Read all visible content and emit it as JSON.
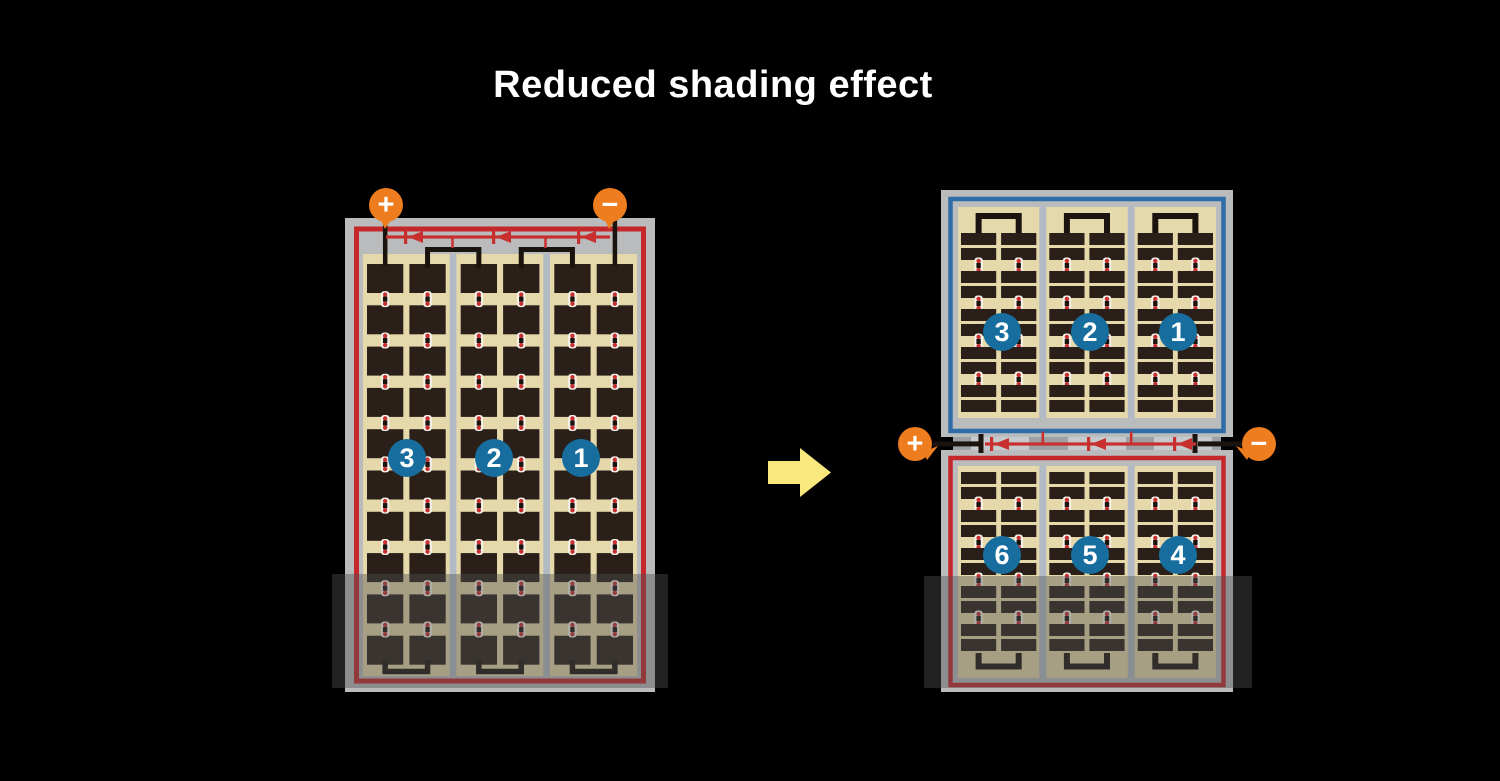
{
  "title": "Reduced shading effect",
  "colors": {
    "background": "#000000",
    "title": "#ffffff",
    "frame": "#b9bbbd",
    "separator": "#b2bac3",
    "cell_area": "#e5d8aa",
    "cell": "#2a2019",
    "connector_black": "#1a130e",
    "red": "#c5282b",
    "blue": "#2f6da7",
    "wire": "#c83030",
    "tab_white": "#f7f3ea",
    "orange": "#ee7d1f",
    "badge": "#176e9e",
    "arrow": "#f8e87e",
    "band": "#9ea1a4",
    "band_block": "#c7cacc",
    "shade": "rgba(80,80,80,0.42)"
  },
  "left_module": {
    "terminals": {
      "positive": "+",
      "negative": "−"
    },
    "cell_strings": [
      "3",
      "2",
      "1"
    ]
  },
  "right_module": {
    "terminals": {
      "positive": "+",
      "negative": "−"
    },
    "top_cell_strings": [
      "3",
      "2",
      "1"
    ],
    "bottom_cell_strings": [
      "6",
      "5",
      "4"
    ]
  },
  "icons": {
    "arrow": "right-arrow",
    "diode": "bypass-diode"
  }
}
